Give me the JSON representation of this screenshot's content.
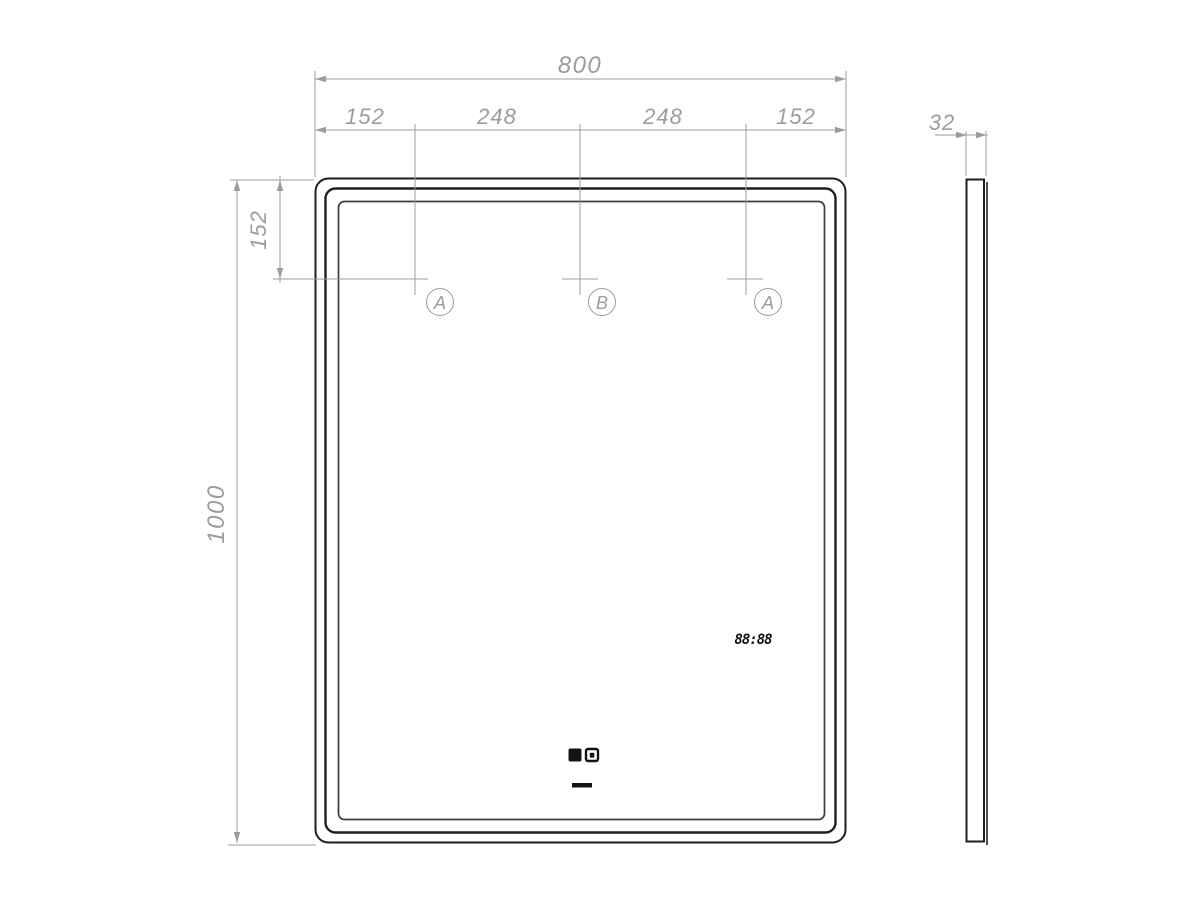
{
  "front_view": {
    "width_label": "800",
    "segment_labels": [
      "152",
      "248",
      "248",
      "152"
    ],
    "height_label": "1000",
    "mount_offset_label": "152",
    "mount_markers": [
      "A",
      "B",
      "A"
    ],
    "clock_text": "88:88"
  },
  "side_view": {
    "thickness_label": "32"
  },
  "colors": {
    "outline": "#1f1f1f",
    "outline_soft": "#3d3d3d",
    "dimension": "#9c9c9c",
    "display": "#0d0d0d",
    "background": "#ffffff"
  }
}
